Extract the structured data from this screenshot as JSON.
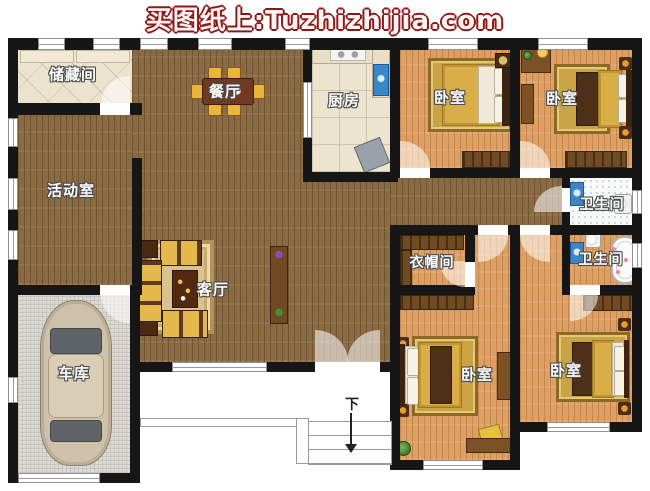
{
  "header": {
    "title": "买图纸上:Tuzhizhijia.com",
    "text_color": "#8b1a17"
  },
  "rooms": [
    {
      "id": "storage",
      "label": "储藏间"
    },
    {
      "id": "activity",
      "label": "活动室"
    },
    {
      "id": "dining",
      "label": "餐厅"
    },
    {
      "id": "kitchen",
      "label": "厨房"
    },
    {
      "id": "bedroom-top-middle",
      "label": "卧室"
    },
    {
      "id": "bedroom-top-right",
      "label": "卧室"
    },
    {
      "id": "bathroom-upper",
      "label": "卫生间"
    },
    {
      "id": "bathroom-lower",
      "label": "卫生间"
    },
    {
      "id": "cloakroom",
      "label": "衣帽间"
    },
    {
      "id": "living",
      "label": "客厅"
    },
    {
      "id": "garage",
      "label": "车库"
    },
    {
      "id": "bedroom-bottom-middle",
      "label": "卧室"
    },
    {
      "id": "bedroom-bottom-right",
      "label": "卧室"
    }
  ],
  "stairs": {
    "down_label": "下"
  },
  "colors": {
    "header_text": "#8b1a17",
    "wall": "#161616",
    "wood_dark": "#8a6a43",
    "wood_light": "#de9f62",
    "tile": "#ece3cf",
    "bath_floor": "#f7f8f8",
    "garage_floor": "#dbd9d3",
    "bed_gold": "#d9ae47",
    "sink_blue": "#3a86c8"
  }
}
